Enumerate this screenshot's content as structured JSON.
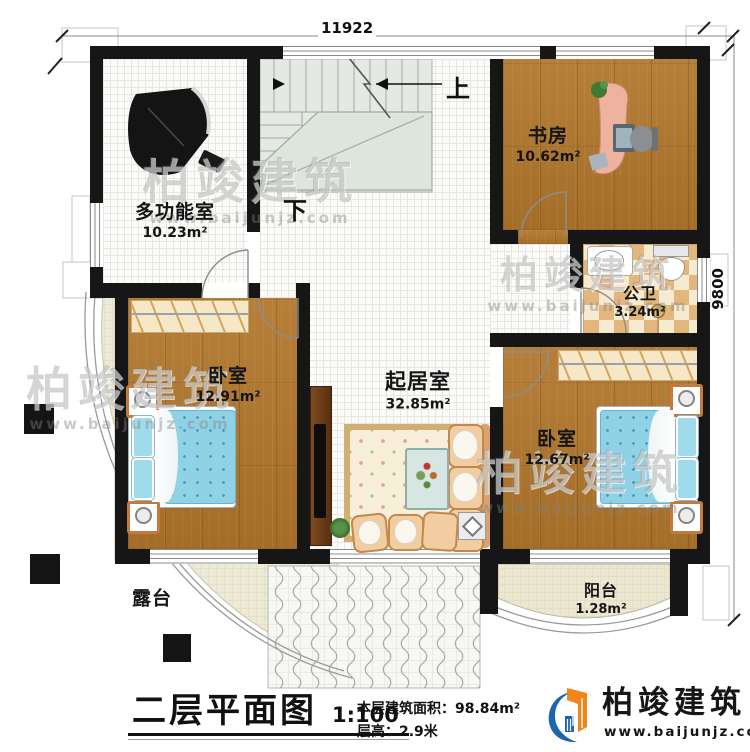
{
  "canvas": {
    "width": 750,
    "height": 752
  },
  "colors": {
    "wall": "#161616",
    "wood_floor": "#b0762c",
    "tile_floor": "#fbfbf9",
    "stair_floor": "#e4eae3",
    "bath_tile": "#e2b67c",
    "terrace_floor": "#eeead8",
    "bed": "#8fd2e6",
    "logo_orange": "#f08519",
    "logo_blue": "#1d66ad"
  },
  "dimensions": {
    "width_mm": "11922",
    "height_mm": "9800"
  },
  "rooms": {
    "multi": {
      "name": "多功能室",
      "area": "10.23m²"
    },
    "study": {
      "name": "书房",
      "area": "10.62m²"
    },
    "bath": {
      "name": "公卫",
      "area": "3.24m²"
    },
    "bed_left": {
      "name": "卧室",
      "area": "12.91m²"
    },
    "living": {
      "name": "起居室",
      "area": "32.85m²"
    },
    "bed_right": {
      "name": "卧室",
      "area": "12.67m²"
    },
    "terrace": {
      "name": "露台"
    },
    "balcony": {
      "name": "阳台",
      "area": "1.28m²"
    }
  },
  "stairs": {
    "up_label": "上",
    "down_label": "下"
  },
  "titleblock": {
    "title": "二层平面图",
    "scale": "1:100",
    "area_line": "本层建筑面积：98.84m²",
    "floor_height_line": "层高：2.9米"
  },
  "brand": {
    "name": "柏竣建筑",
    "website": "www.baijunjz.com"
  },
  "watermark": {
    "text": "柏竣建筑",
    "url": "www.baijunjz.com"
  }
}
